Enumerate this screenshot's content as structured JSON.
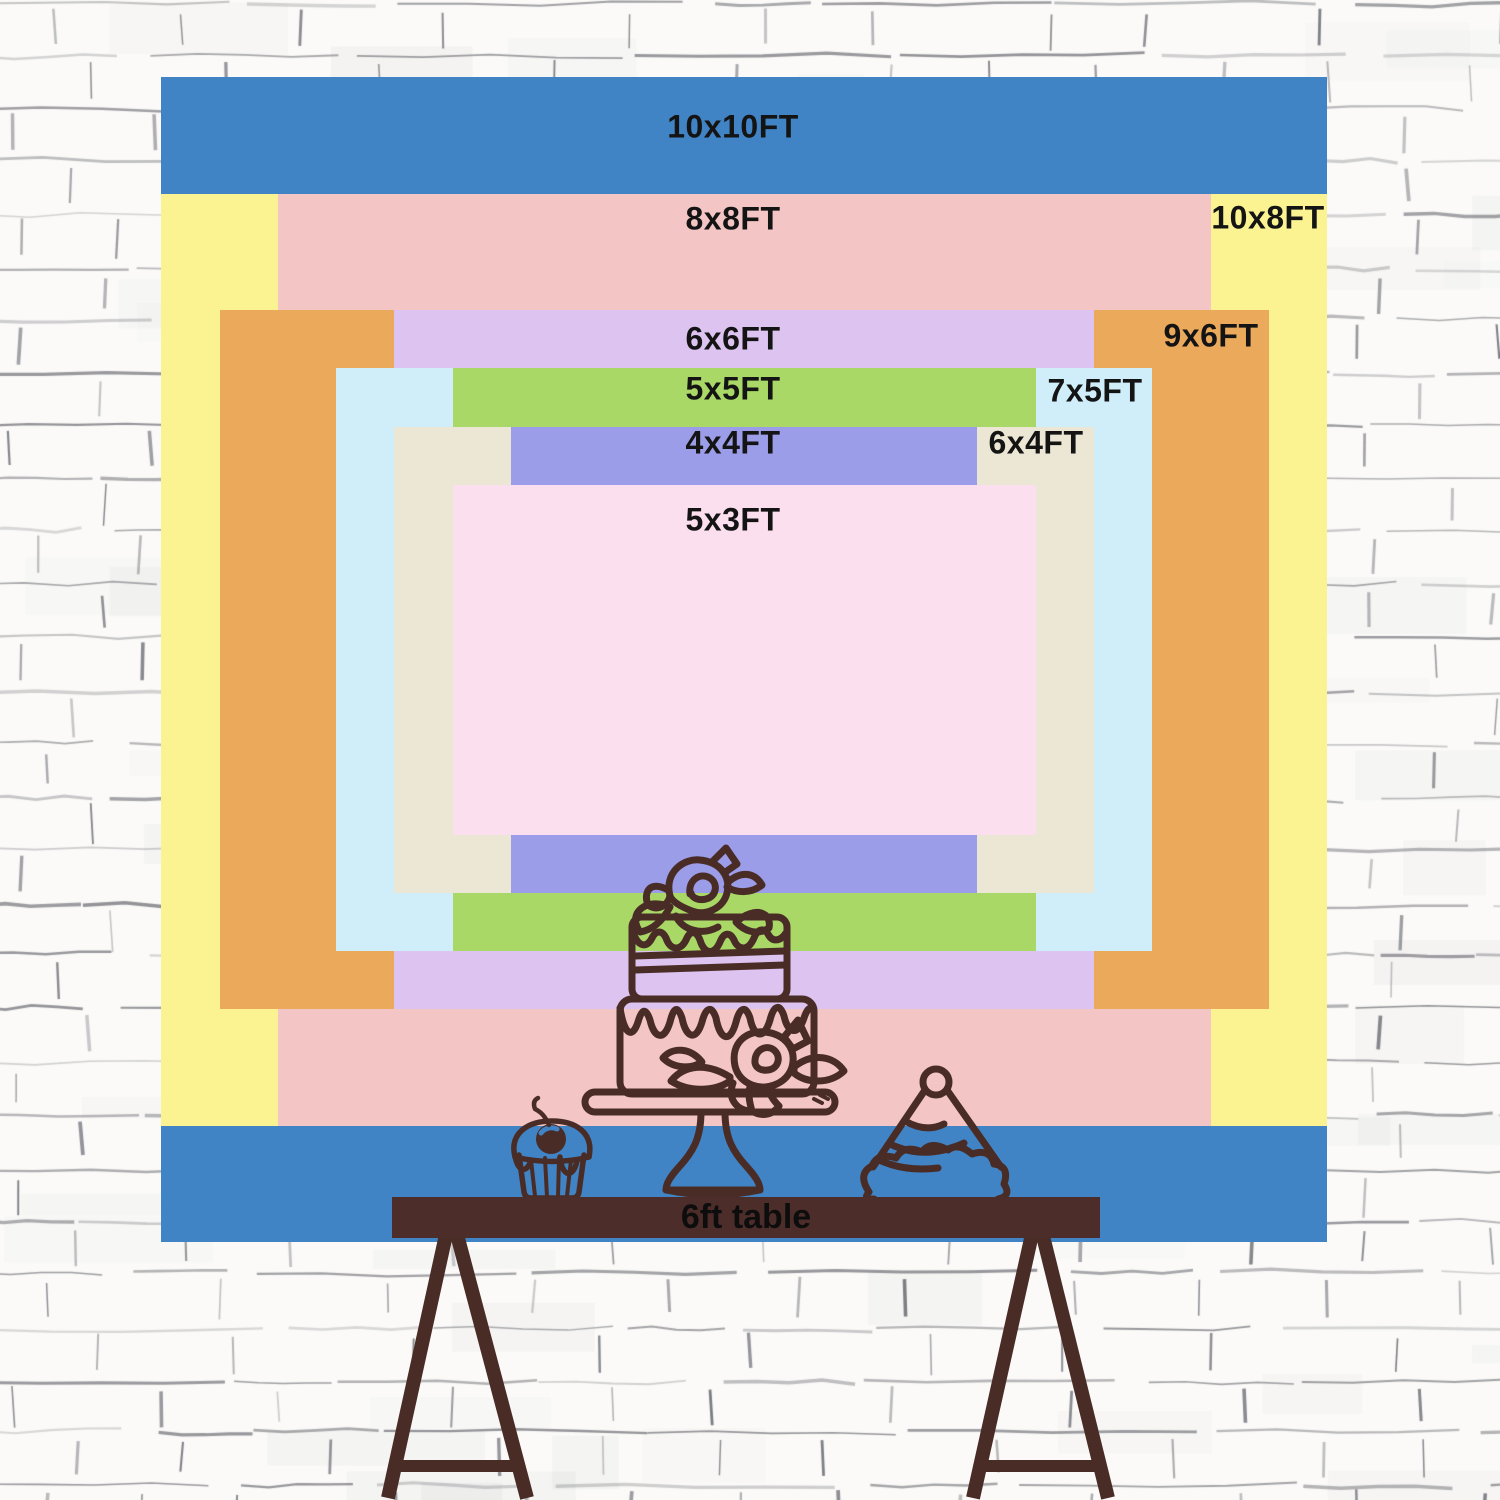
{
  "title": "Backdrop size comparison chart",
  "colors": {
    "wall_background": "#fbfaf8",
    "wall_mortar": "#5f6068",
    "line_art": "#4a2c27",
    "table_wood": "#4c2d2a",
    "label_text": "#141414"
  },
  "banner": {
    "x": 161,
    "y": 77,
    "w": 1166,
    "h": 1165,
    "px_per_ft_x": 116.6,
    "px_per_ft_y": 116.5,
    "sizes": [
      {
        "id": "10x10",
        "label": "10x10FT",
        "color": "#4184c5",
        "ft_w": 10,
        "ft_h": 10,
        "label_side": "center",
        "label_x": 733,
        "label_y": 127
      },
      {
        "id": "10x8",
        "label": "10x8FT",
        "color": "#fbf392",
        "ft_w": 10,
        "ft_h": 8,
        "label_side": "right",
        "label_x": 1268,
        "label_y": 218
      },
      {
        "id": "8x8",
        "label": "8x8FT",
        "color": "#f3c6c5",
        "ft_w": 8,
        "ft_h": 8,
        "label_side": "center",
        "label_x": 733,
        "label_y": 219
      },
      {
        "id": "9x6",
        "label": "9x6FT",
        "color": "#ebaa5b",
        "ft_w": 9,
        "ft_h": 6,
        "label_side": "right",
        "label_x": 1211,
        "label_y": 336
      },
      {
        "id": "6x6",
        "label": "6x6FT",
        "color": "#dcc3f0",
        "ft_w": 6,
        "ft_h": 6,
        "label_side": "center",
        "label_x": 733,
        "label_y": 339
      },
      {
        "id": "7x5",
        "label": "7x5FT",
        "color": "#cfeef9",
        "ft_w": 7,
        "ft_h": 5,
        "label_side": "right",
        "label_x": 1095,
        "label_y": 391
      },
      {
        "id": "5x5",
        "label": "5x5FT",
        "color": "#a9d867",
        "ft_w": 5,
        "ft_h": 5,
        "label_side": "center",
        "label_x": 733,
        "label_y": 389
      },
      {
        "id": "6x4",
        "label": "6x4FT",
        "color": "#ece6d4",
        "ft_w": 6,
        "ft_h": 4,
        "label_side": "right",
        "label_x": 1036,
        "label_y": 443
      },
      {
        "id": "4x4",
        "label": "4x4FT",
        "color": "#9c9de9",
        "ft_w": 4,
        "ft_h": 4,
        "label_side": "center",
        "label_x": 733,
        "label_y": 443
      },
      {
        "id": "5x3",
        "label": "5x3FT",
        "color": "#fcdfee",
        "ft_w": 5,
        "ft_h": 3,
        "label_side": "center",
        "label_x": 733,
        "label_y": 520
      }
    ]
  },
  "table": {
    "label": "6ft table"
  },
  "illustrations": [
    {
      "name": "tiered-cake-icon"
    },
    {
      "name": "cupcake-icon"
    },
    {
      "name": "party-hat-icon"
    },
    {
      "name": "trestle-table-icon"
    }
  ]
}
